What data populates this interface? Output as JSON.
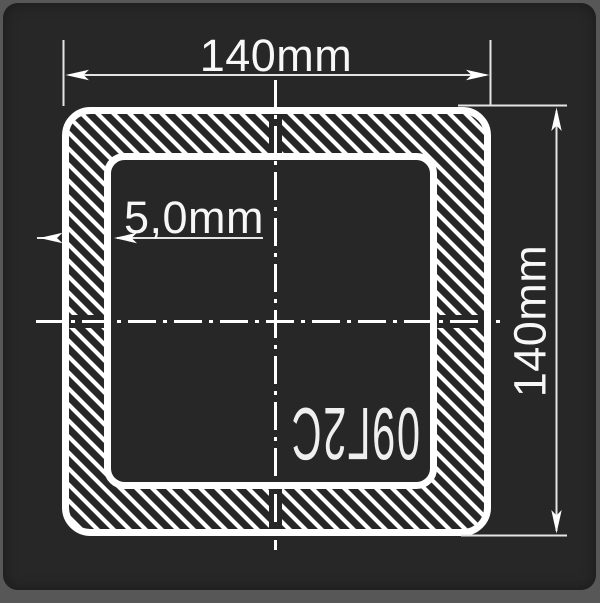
{
  "drawing": {
    "type": "square-tube-cross-section",
    "dimensions": {
      "outer_width": "140mm",
      "outer_height": "140mm",
      "wall_thickness": "5,0mm"
    },
    "material": {
      "steel_grade": "09Г2С"
    },
    "colors": {
      "frame_background": "#575757",
      "panel_background": "#272727",
      "geometry_line": "#ffffff",
      "dimension_line": "#e4e4e4",
      "text": "#f7f7f7"
    }
  }
}
